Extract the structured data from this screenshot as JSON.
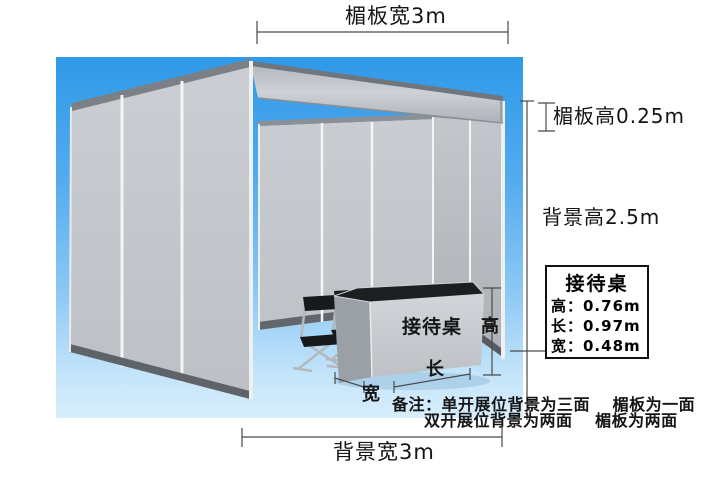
{
  "illustration": {
    "description_colors": {
      "sky_top": "#2f99e8",
      "sky_bottom": "#d8eefc",
      "wall_gray": "#c6cace",
      "panel_seam": "#f3f5f7",
      "edge_dark": "#5d6368",
      "desk_top": "#1c1e20",
      "line_color": "#4a4a4a"
    }
  },
  "dimensions": {
    "top_width_label": "楣板宽3m",
    "lintel_height_label": "楣板高0.25m",
    "background_height_label": "背景高2.5m",
    "background_width_label": "背景宽3m"
  },
  "desk": {
    "label": "接待桌",
    "height_char": "高",
    "length_char": "长",
    "width_char": "宽"
  },
  "info_box": {
    "title": "接待桌",
    "rows": [
      "高：0.76m",
      "长：0.97m",
      "宽：0.48m"
    ]
  },
  "notes": {
    "line1": "备注：单开展位背景为三面　 楣板为一面",
    "line2": "双开展位背景为两面　 楣板为两面"
  }
}
